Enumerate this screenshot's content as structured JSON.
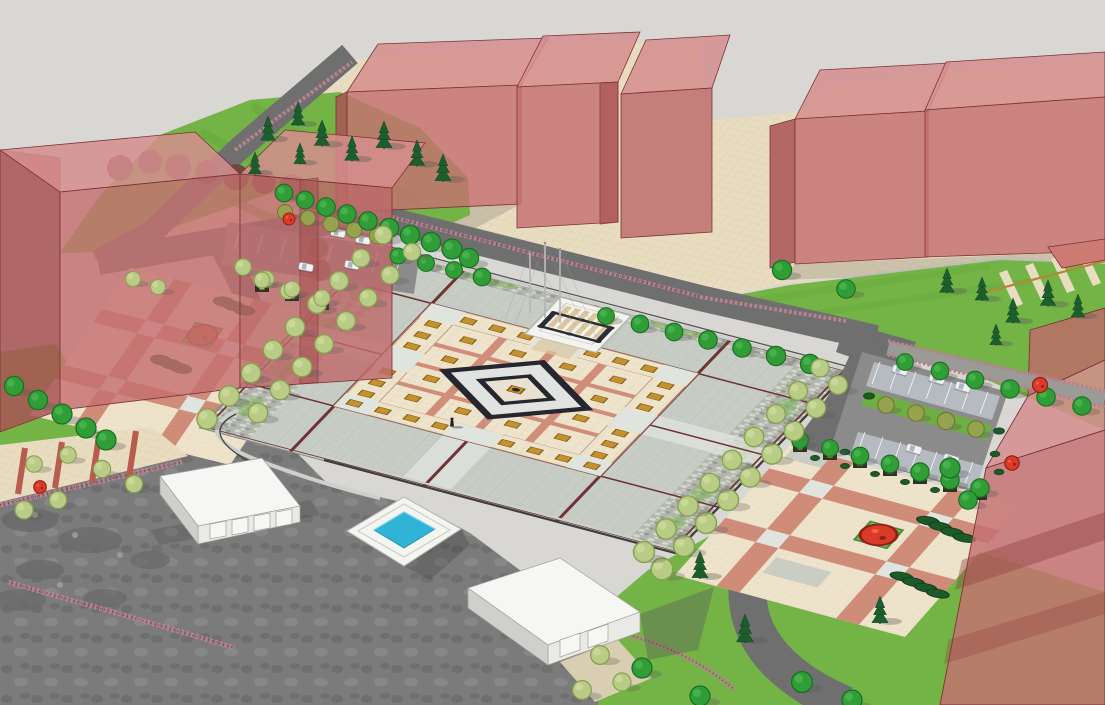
{
  "scene": {
    "description": "Aerial SketchUp-style 3D massing render of a civic square design: translucent red building masses around a large paved central plaza with a diamond-motif centerpiece, three flagpoles on a white platform, tree-lined plaza edges, two parking lots with cars, a square reflecting pool, two low white gate buildings, patterned paved courtyards with planters, hedges and red accent shrubs, lawns and gray roads.",
    "counts": {
      "flagpoles": 3,
      "reflecting_pools": 1,
      "red_massing_buildings": 9,
      "white_buildings": 2,
      "parking_lots": 2,
      "cars": 9,
      "people": 1
    }
  },
  "colors": {
    "sky": "#d8d7d3",
    "red-face": "#c47070",
    "red-top": "#d68e8e",
    "red-side": "#a85454",
    "red-edge": "#7e3136",
    "red-shadow": "#8f3d3d",
    "tan": "#e9ddc1",
    "tan-line": "#d7c6a2",
    "lawn": "#74b446",
    "lawn-stripe": "#65a83a",
    "island-lawn": "#6fae42",
    "road": "#6f6f6f",
    "asphalt": "#7b7b7b",
    "plaza-tile": "#c7ccc5",
    "plaza-line": "#b2b8b0",
    "plaza-pad": "#e0e4df",
    "joint": "#6e3433",
    "cream": "#eee3cb",
    "cream-line": "#d9c9a9",
    "gold": "#c5912f",
    "gold-edge": "#7c5a12",
    "gold-trim": "#b08a3a",
    "salmon": "#d08d7a",
    "pink-line": "#b87363",
    "diamond-line": "#26262e",
    "diamond-fill": "#e1e3e0",
    "diamond-core": "#e9e2d2",
    "platform-white": "#f3f3f0",
    "platform-strip": "#dcc69c",
    "fence": "#2c2c35",
    "pole": "#b6b6ba",
    "pool-white": "#f4f4f1",
    "pool-water": "#2fb4d8",
    "pool-water-edge": "#1d8fae",
    "white-face": "#f6f6f4",
    "white-side": "#e9e9e5",
    "white-dark": "#cfcfcb",
    "white-line": "#a0a09c",
    "stall": "#b9c0c5",
    "car": "#f0f2f4",
    "tree": "#2f9e36",
    "tree-dark": "#1c6e22",
    "tree-light": "#b9cc85",
    "tree-light-dark": "#87a050",
    "olive": "#97a24f",
    "olive-dark": "#6c7733",
    "pine": "#1c5f2c",
    "pine-dark": "#14482a",
    "hedge": "#1d5a2a",
    "shrub-red": "#da3a28",
    "shrub-rust": "#b05a30",
    "path": "#9a9a96",
    "speckle": "#b9808e",
    "speckle-dark": "#7c3f50",
    "stone": "#6a6a6a",
    "curb-light": "#ccd0ca",
    "curb-dark": "#3e3e3c",
    "shadow": "#5a5a55",
    "mottle": "#b2b6ad",
    "mottle-light": "#d3d6cd",
    "mottle-dark": "#959b91",
    "trunk": "#5a4632",
    "planter-dark": "#2d3227",
    "planter-mark": "#c9b53a"
  }
}
